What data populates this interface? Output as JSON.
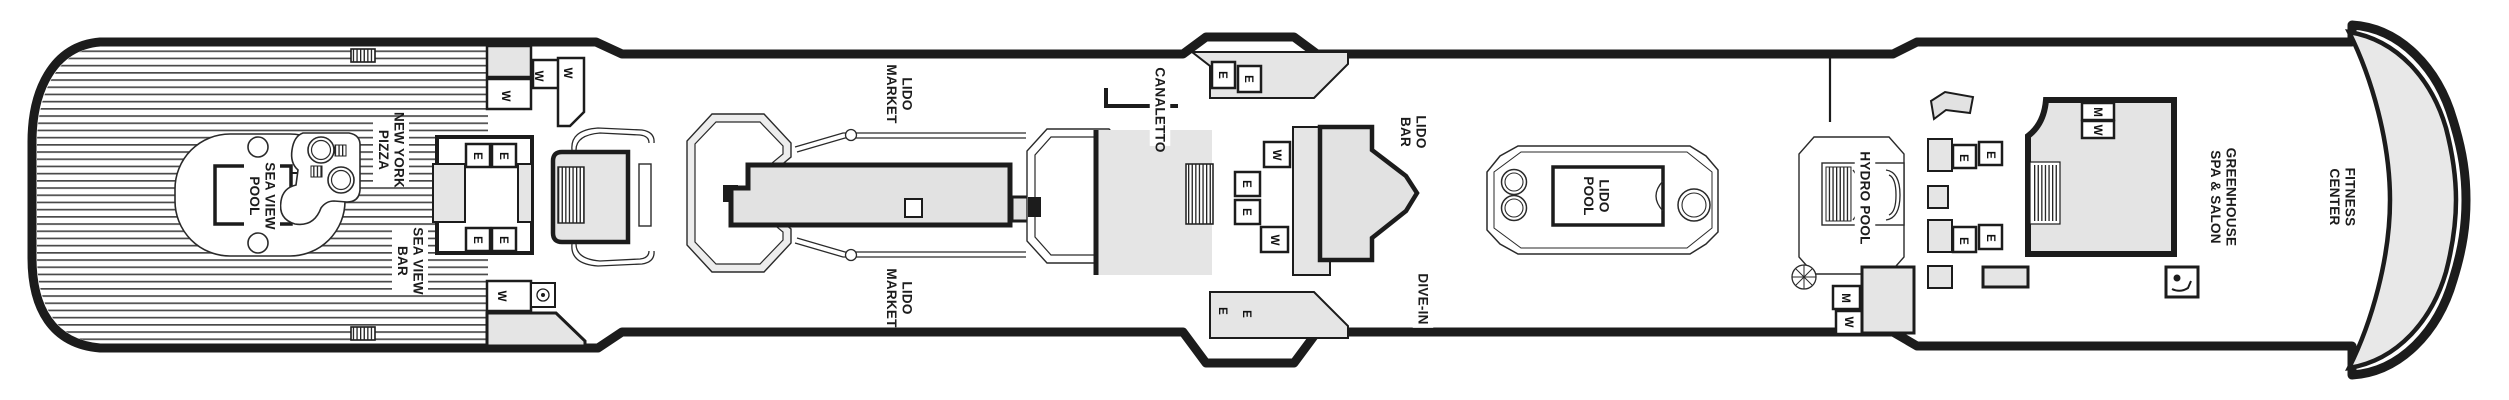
{
  "deck": {
    "venue_labels": [
      {
        "id": "sea-view-pool",
        "lines": [
          "SEA VIEW",
          "POOL"
        ],
        "x": 262,
        "y": 196
      },
      {
        "id": "new-york-pizza",
        "lines": [
          "NEW YORK",
          "PIZZA"
        ],
        "x": 391,
        "y": 150
      },
      {
        "id": "sea-view-bar",
        "lines": [
          "SEA VIEW",
          "BAR"
        ],
        "x": 410,
        "y": 261
      },
      {
        "id": "lido-market-top",
        "lines": [
          "LIDO",
          "MARKET"
        ],
        "x": 899,
        "y": 94
      },
      {
        "id": "lido-market-bottom",
        "lines": [
          "LIDO",
          "MARKET"
        ],
        "x": 899,
        "y": 298
      },
      {
        "id": "canaletto",
        "lines": [
          "CANALETTO"
        ],
        "x": 1160,
        "y": 110
      },
      {
        "id": "lido-bar",
        "lines": [
          "LIDO",
          "BAR"
        ],
        "x": 1413,
        "y": 132
      },
      {
        "id": "lido-pool",
        "lines": [
          "LIDO",
          "POOL"
        ],
        "x": 1596,
        "y": 196
      },
      {
        "id": "dive-in",
        "lines": [
          "DIVE-IN"
        ],
        "x": 1423,
        "y": 299
      },
      {
        "id": "hydro-pool",
        "lines": [
          "HYDRO POOL"
        ],
        "x": 1865,
        "y": 198
      },
      {
        "id": "greenhouse-spa-salon",
        "lines": [
          "GREENHOUSE",
          "SPA & SALON"
        ],
        "x": 2223,
        "y": 197
      },
      {
        "id": "fitness-center",
        "lines": [
          "FITNESS",
          "CENTER"
        ],
        "x": 2342,
        "y": 197
      }
    ],
    "room_letters": [
      {
        "ch": "W",
        "x": 506,
        "y": 96
      },
      {
        "ch": "W",
        "x": 539,
        "y": 76
      },
      {
        "ch": "W",
        "x": 568,
        "y": 73
      },
      {
        "ch": "E",
        "x": 478,
        "y": 156
      },
      {
        "ch": "E",
        "x": 504,
        "y": 156
      },
      {
        "ch": "E",
        "x": 478,
        "y": 240
      },
      {
        "ch": "E",
        "x": 504,
        "y": 240
      },
      {
        "ch": "W",
        "x": 502,
        "y": 296
      },
      {
        "ch": "E",
        "x": 1223,
        "y": 75
      },
      {
        "ch": "E",
        "x": 1249,
        "y": 79
      },
      {
        "ch": "W",
        "x": 1277,
        "y": 155
      },
      {
        "ch": "E",
        "x": 1247,
        "y": 184
      },
      {
        "ch": "E",
        "x": 1247,
        "y": 212
      },
      {
        "ch": "W",
        "x": 1275,
        "y": 240
      },
      {
        "ch": "E",
        "x": 1223,
        "y": 311
      },
      {
        "ch": "E",
        "x": 1247,
        "y": 314
      },
      {
        "ch": "M",
        "x": 1846,
        "y": 298
      },
      {
        "ch": "W",
        "x": 1849,
        "y": 322
      },
      {
        "ch": "E",
        "x": 1964,
        "y": 158
      },
      {
        "ch": "E",
        "x": 1991,
        "y": 155
      },
      {
        "ch": "E",
        "x": 1964,
        "y": 241
      },
      {
        "ch": "E",
        "x": 1991,
        "y": 238
      },
      {
        "ch": "M",
        "x": 2098,
        "y": 112
      },
      {
        "ch": "W",
        "x": 2098,
        "y": 130
      }
    ],
    "colors": {
      "outline": "#1c1c1c",
      "room_gray": "#e5e5e5",
      "stripe": "#4a4a4a",
      "label_text": "#1c1c1c"
    }
  }
}
